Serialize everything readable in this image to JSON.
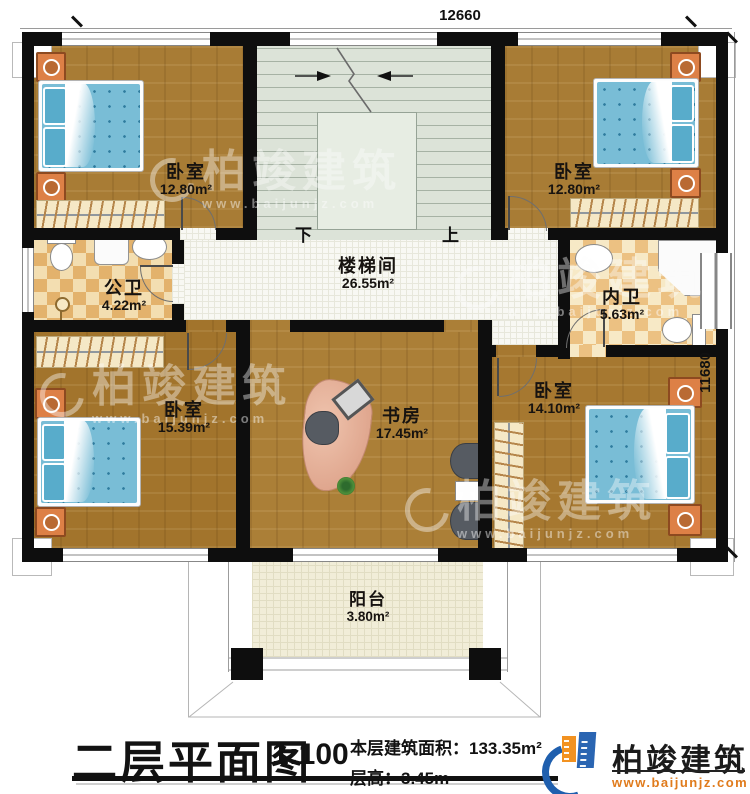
{
  "dims": {
    "top": "12660",
    "right": "11680"
  },
  "stairwell": {
    "down_label": "下",
    "up_label": "上"
  },
  "rooms": {
    "bedroom_tl": {
      "name": "卧室",
      "area": "12.80m²"
    },
    "bedroom_tr": {
      "name": "卧室",
      "area": "12.80m²"
    },
    "bath_public": {
      "name": "公卫",
      "area": "4.22m²"
    },
    "stair_hall": {
      "name": "楼梯间",
      "area": "26.55m²"
    },
    "bath_private": {
      "name": "内卫",
      "area": "5.63m²"
    },
    "bedroom_bl": {
      "name": "卧室",
      "area": "15.39m²"
    },
    "study": {
      "name": "书房",
      "area": "17.45m²"
    },
    "bedroom_br": {
      "name": "卧室",
      "area": "14.10m²"
    },
    "balcony": {
      "name": "阳台",
      "area": "3.80m²"
    }
  },
  "titlebar": {
    "title": "二层平面图",
    "scale": "1:100",
    "area_label": "本层建筑面积：",
    "area_value": "133.35m²",
    "height_label": "层高：",
    "height_value": "3.45m"
  },
  "brand": {
    "name": "柏竣建筑",
    "website": "www.baijunjz.com"
  },
  "colors": {
    "wall": "#0e0e0e",
    "wood": "#a87c35",
    "stair_floor": "#dce3d8",
    "hall_tile": "#f8f8f3",
    "bath_checker": "#e3b26c",
    "bed_blue": "#79bdd6",
    "brand_blue": "#2a65b2",
    "brand_orange": "#f29221",
    "site_orange": "#e07b1c"
  }
}
